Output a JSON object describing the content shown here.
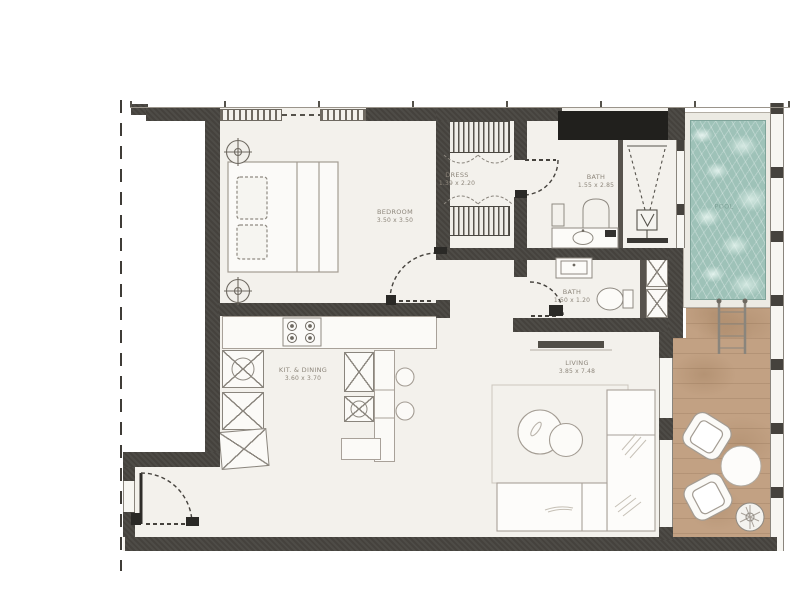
{
  "plan": {
    "type": "apartment-floor-plan",
    "rooms": [
      {
        "name": "BEDROOM",
        "dims": "3.50 x 3.50"
      },
      {
        "name": "DRESS",
        "dims": "1.39 x 2.20"
      },
      {
        "name": "BATH",
        "dims": "1.55 x 2.85"
      },
      {
        "name": "BATH",
        "dims": "1.50 x 1.20"
      },
      {
        "name": "KIT. & DINING",
        "dims": "3.60 x 3.70"
      },
      {
        "name": "LIVING",
        "dims": "3.85 x 7.48"
      },
      {
        "name": "POOL",
        "dims": ""
      }
    ],
    "colors": {
      "wall": "#45423d",
      "wall_shaft": "#21201d",
      "floor": "#f3f1ec",
      "background": "#ffffff",
      "pool_water": "#9ec2b8",
      "deck_wood": "#c2a183",
      "furniture_line": "#a39c93",
      "label_text": "#8d867b"
    }
  }
}
